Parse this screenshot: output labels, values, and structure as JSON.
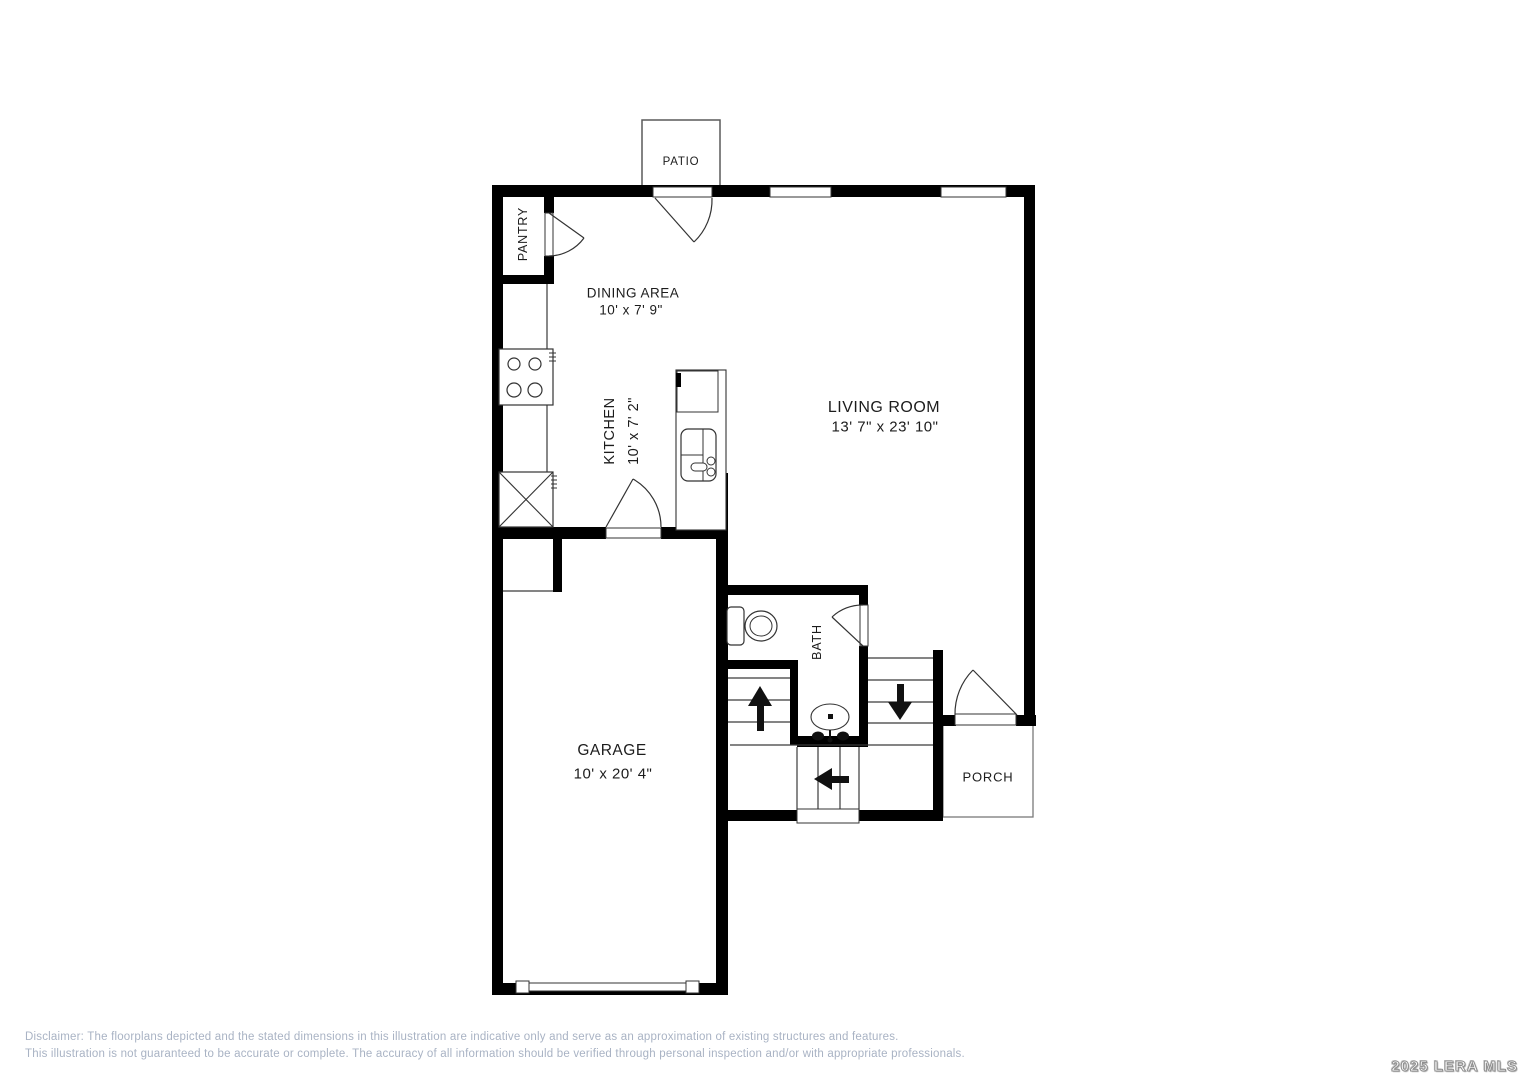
{
  "plan": {
    "patio": {
      "label": "PATIO"
    },
    "pantry": {
      "label": "PANTRY"
    },
    "dining": {
      "label": "DINING AREA",
      "dimension": "10' x 7' 9\""
    },
    "kitchen": {
      "label": "KITCHEN",
      "dimension": "10' x 7' 2\""
    },
    "living": {
      "label": "LIVING ROOM",
      "dimension": "13' 7\" x 23' 10\""
    },
    "garage": {
      "label": "GARAGE",
      "dimension": "10' x 20' 4\""
    },
    "bath": {
      "label": "BATH"
    },
    "porch": {
      "label": "PORCH"
    }
  },
  "footer": {
    "disclaimer_line1": "Disclaimer: The floorplans depicted and the stated dimensions in this illustration are indicative only and serve as an approximation of existing structures and features.",
    "disclaimer_line2": "This illustration is not guaranteed to be accurate or complete. The accuracy of all information should be verified through personal inspection and/or with appropriate professionals.",
    "watermark": "2025 LERA MLS"
  },
  "colors": {
    "wall": "#000000",
    "thin_line": "#3a3a3a",
    "disclaimer_text": "#a9b3c4",
    "watermark_fill": "#ffffff",
    "watermark_outline": "#8f8f8f",
    "background": "#ffffff"
  }
}
